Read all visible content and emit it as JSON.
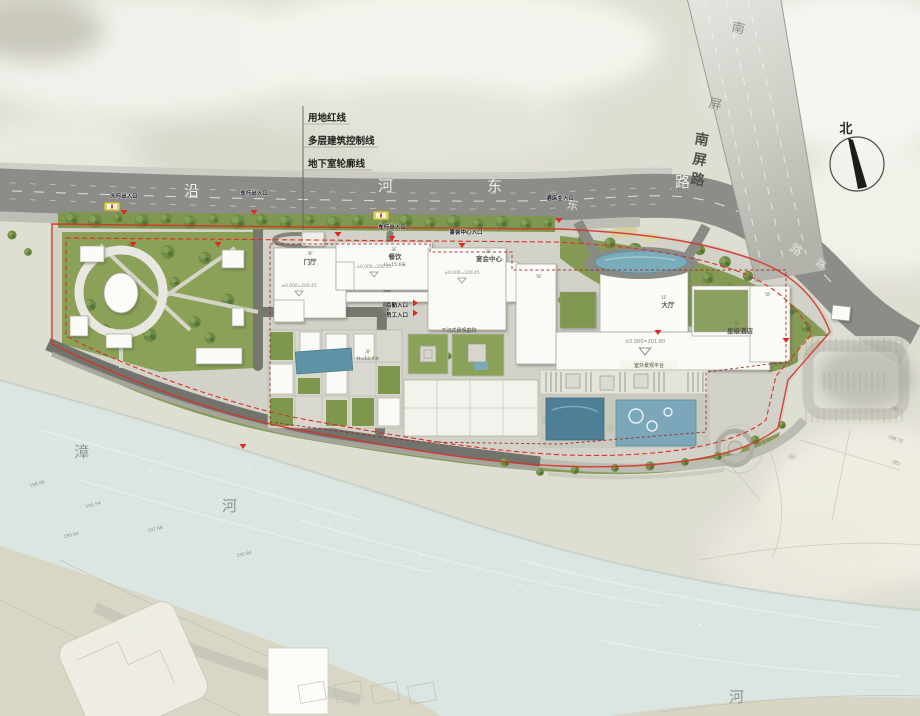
{
  "legend": {
    "items": [
      "用地红线",
      "多层建筑控制线",
      "地下室轮廓线"
    ]
  },
  "compass": {
    "north": "北"
  },
  "roads": {
    "riverside": {
      "name": "沿河东路",
      "c0": "沿",
      "c1": "河",
      "c2": "东",
      "c3": "路",
      "s0": "东",
      "s1": "路",
      "s2": "路"
    },
    "nanping": {
      "name": "南屏路",
      "c0": "南",
      "c1": "屏",
      "v0": "南",
      "v1": "屏",
      "v2": "路"
    }
  },
  "entrances": {
    "pedestrian": "人行出入口",
    "vehicle": "车行出入口",
    "vehicle2": "车行出入口",
    "banquet": "宴会中心入口",
    "hotel": "酒店主入口",
    "logistics": "后勤入口",
    "staff": "员工入口"
  },
  "buildings": {
    "menting": {
      "floor": "3F",
      "name": "门厅",
      "elev": "±0.000=200.45"
    },
    "canyin": {
      "floor": "3F",
      "name": "餐饮",
      "height": "H=15.6米",
      "elev": "±0.000=200.45"
    },
    "yanhui": {
      "floor": "3F",
      "name": "宴会中心",
      "elev": "±0.000=200.45"
    },
    "hotel": {
      "hall_floor": "1F",
      "hall": "大厅",
      "floor": "5F",
      "name": "星级酒店",
      "elev": "±0.000=201.80",
      "wing_west": "5F",
      "wing_east": "5F"
    },
    "block": {
      "floor": "3F",
      "height": "H=12.4米"
    }
  },
  "features": {
    "sunken": "下沉式景观庭院",
    "terrace": "室外景观平台"
  },
  "river": {
    "name_a": "漳",
    "name_b": "河",
    "name_c": "河"
  },
  "survey": {
    "e1": "198.89",
    "e2": "195.54",
    "e3": "197.68",
    "e4": "195.90",
    "e5": "192.84",
    "e6": "196.32",
    "rock": "(石)"
  }
}
